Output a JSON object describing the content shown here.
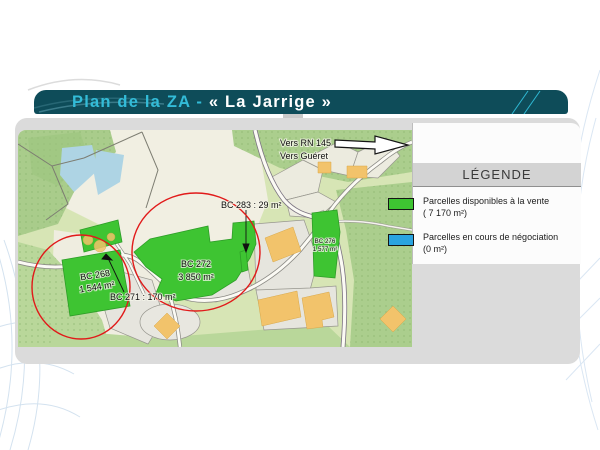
{
  "slide": {
    "title_part1": "Plan de la ZA - ",
    "title_part2": "« La Jarrige »"
  },
  "legend": {
    "heading": "LÉGENDE",
    "available": {
      "line1": "Parcelles disponibles à la vente",
      "line2": "( 7 170 m²)"
    },
    "negotiation": {
      "line1": "Parcelles en cours de négociation",
      "line2": "(0 m²)"
    }
  },
  "map": {
    "sign": {
      "line1": "Vers RN 145",
      "line2": "Vers Guéret"
    },
    "bc272": {
      "id": "BC 272",
      "area": "3 850 m²"
    },
    "bc268": {
      "id": "BC 268",
      "area": "1 544 m²"
    },
    "bc276": {
      "id": "BC 276",
      "area": "1 577 m²"
    },
    "bc283_label": "BC 283 :  29 m²",
    "bc271_label": "BC 271 :  170 m²"
  },
  "colors": {
    "banner_teal": "#0e4c59",
    "accent_cyan": "#33bcd8",
    "available_green": "#3ec432",
    "negotiation_blue": "#2aa4e0",
    "highlight_red": "#e11a1a"
  }
}
